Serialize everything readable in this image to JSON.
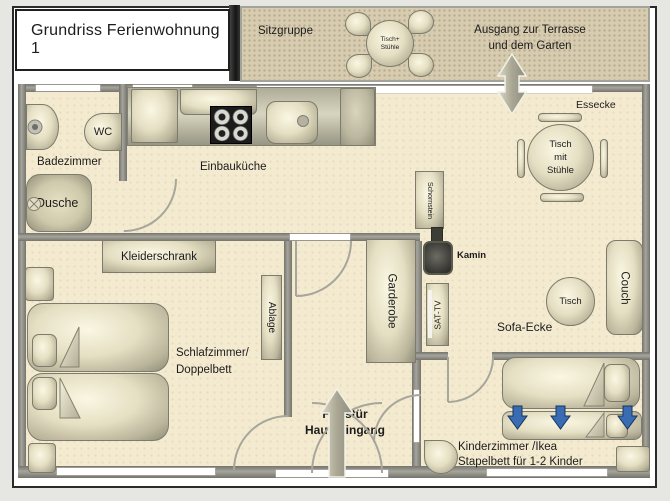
{
  "title": "Grundriss  Ferienwohnung 1",
  "terrace": {
    "label": "Sitzgruppe",
    "table": {
      "line1": "Tisch+",
      "line2": "Stühle"
    },
    "exit": {
      "line1": "Ausgang zur Terrasse",
      "line2": "und dem Garten"
    }
  },
  "bathroom": {
    "label": "Badezimmer",
    "wc": "WC",
    "shower": "Dusche"
  },
  "kitchen": {
    "label": "Einbauküche"
  },
  "dining": {
    "label": "Essecke",
    "table": {
      "line1": "Tisch",
      "line2": "mit",
      "line3": "Stühle"
    }
  },
  "living": {
    "label": "Sofa-Ecke",
    "couch": "Couch",
    "table": "Tisch",
    "chimney": "Schornstein",
    "fireplace": "Kamin",
    "tv": "SAT-TV"
  },
  "bedroom": {
    "label": {
      "line1": "Schlafzimmer/",
      "line2": "Doppelbett"
    },
    "wardrobe": "Kleiderschrank",
    "shelf": "Ablage"
  },
  "hall": {
    "closet": "Garderobe",
    "entrance": {
      "line1": "Haustür",
      "line2": "Haupteingang"
    }
  },
  "kids": {
    "label": {
      "line1": "Kinderzimmer /Ikea",
      "line2": "Stapelbett für 1-2 Kinder"
    }
  },
  "colors": {
    "floor": "#f3ead0",
    "terrace": "#d7cbb0",
    "wall": "#8b8b84",
    "page": "#ffffff",
    "accent_blue": "#3a6cb3",
    "text": "#1c1c1c"
  }
}
